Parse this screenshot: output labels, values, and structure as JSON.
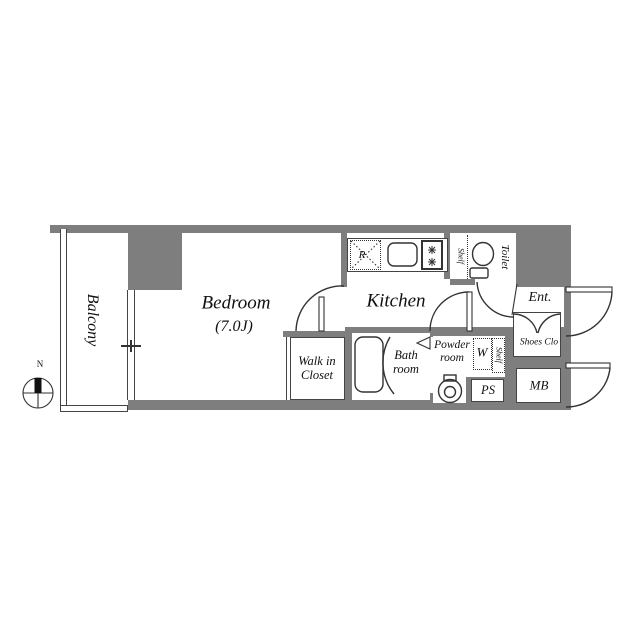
{
  "floorplan": {
    "compass": {
      "north_label": "N"
    },
    "rooms": {
      "balcony": {
        "label": "Balcony"
      },
      "bedroom": {
        "label": "Bedroom",
        "size": "(7.0J)"
      },
      "kitchen": {
        "label": "Kitchen"
      },
      "walk_in_closet": {
        "label": "Walk in Closet"
      },
      "bath": {
        "label": "Bath room"
      },
      "powder": {
        "label": "Powder room"
      },
      "toilet": {
        "label": "Toilet"
      },
      "entrance": {
        "label": "Ent."
      },
      "shoes_closet": {
        "label": "Shoes Clo"
      },
      "meter_box": {
        "label": "MB"
      },
      "pipe_space": {
        "label": "PS"
      }
    },
    "fixtures": {
      "refrigerator": {
        "label": "R"
      },
      "washer": {
        "label": "W"
      },
      "shelf_toilet": {
        "label": "Shelf"
      },
      "shelf_powder": {
        "label": "Shelf"
      }
    },
    "icons": {
      "compass-icon": "circle with cross and black north needle",
      "toilet-icon": "plan-view toilet bowl with tank",
      "bathtub-icon": "rounded rectangle tub",
      "kitchen-sink-icon": "rounded square sink",
      "stove-icon": "two-burner stove with star burners",
      "washbasin-icon": "round basin with faucet",
      "door-arc-icon": "quarter-circle swing arc",
      "window-icon": "double-line sliding window"
    },
    "colors": {
      "wall": "#7e7e7e",
      "line": "#333333",
      "text": "#111111"
    }
  }
}
